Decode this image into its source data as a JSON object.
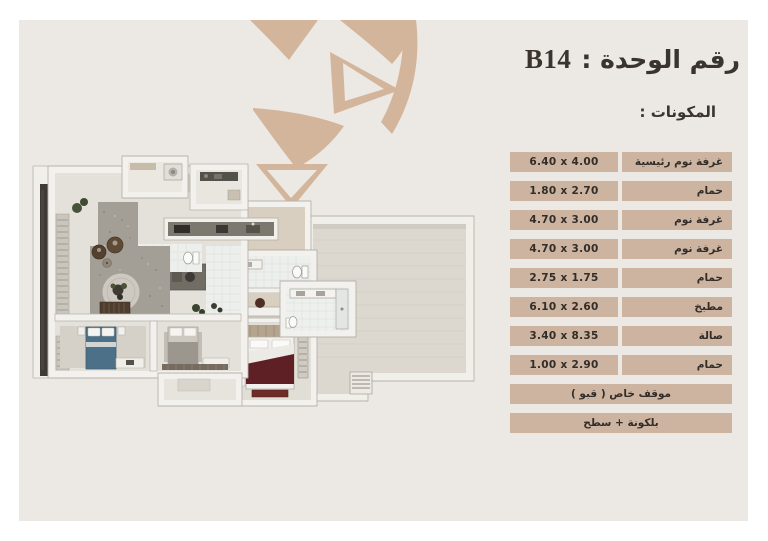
{
  "header": {
    "title_label": "رقم الوحدة :",
    "unit_number": "B14",
    "components_heading": "المكونات :"
  },
  "components_table": {
    "rows": [
      {
        "label": "غرفة نوم رئيسية",
        "dimensions": "6.40 x 4.00"
      },
      {
        "label": "حمام",
        "dimensions": "1.80 x 2.70"
      },
      {
        "label": "غرفة نوم",
        "dimensions": "4.70 x 3.00"
      },
      {
        "label": "غرفة نوم",
        "dimensions": "4.70 x 3.00"
      },
      {
        "label": "حمام",
        "dimensions": "2.75 x 1.75"
      },
      {
        "label": "مطبخ",
        "dimensions": "6.10 x 2.60"
      },
      {
        "label": "صالة",
        "dimensions": "3.40 x 8.35"
      },
      {
        "label": "حمام",
        "dimensions": "1.00 x 2.90"
      }
    ],
    "full_rows": [
      {
        "label": "موقف خاص ( قبو )"
      },
      {
        "label": "بلكونة + سطح"
      }
    ]
  },
  "floor_plan": {
    "description": "3D top-down floor plan render of the unit",
    "features": [
      "living-area",
      "kitchen",
      "bathrooms",
      "two-bedrooms",
      "master-bedroom",
      "balcony",
      "roof-terrace",
      "laundry-nook"
    ]
  },
  "colors": {
    "page_margin": "#FFFFFF",
    "panel_background": "#ECE9E4",
    "motif_tan": "#D3B59C",
    "table_cell": "#CCB4A1",
    "text_dark": "#322D28",
    "blue_bed": "#4D7089",
    "maroon_bed": "#5E2024"
  }
}
